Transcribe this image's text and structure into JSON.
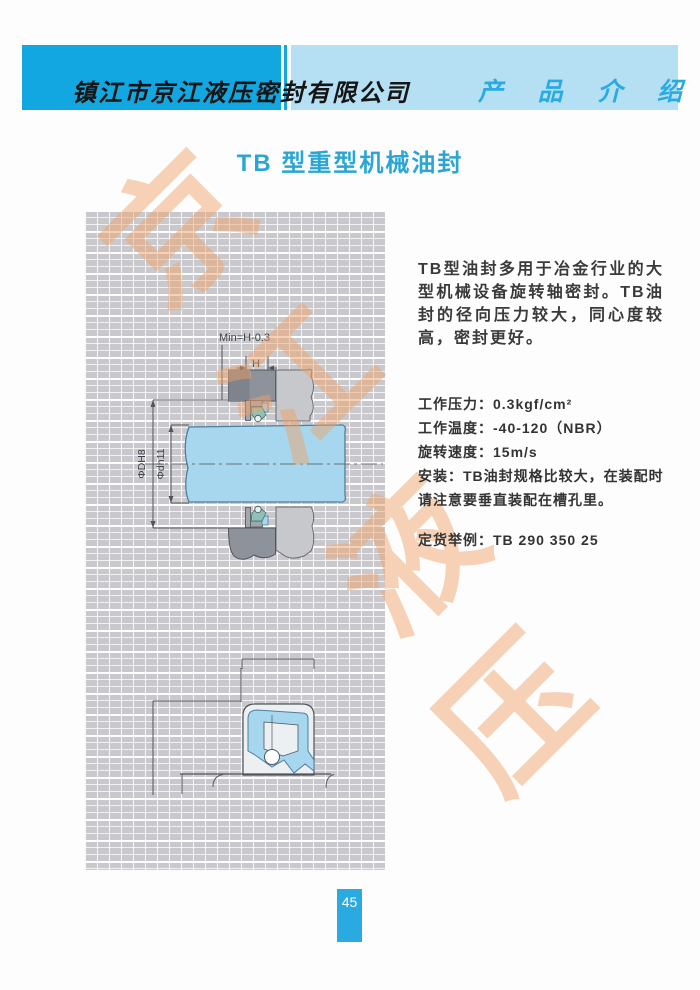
{
  "colors": {
    "accent": "#29ABE2",
    "header_dark": "#12A7E0",
    "header_light": "#B5DFF3",
    "title": "#2BA6D4",
    "watermark": "#F0A268",
    "shaft_blue": "#A6D7EE",
    "shaft_outline": "#4E7F9E",
    "grid_bg": "#C9C9CD"
  },
  "header": {
    "company": "镇江市京江液压密封有限公司",
    "section_title": "产 品 介 绍"
  },
  "page_title": "TB 型重型机械油封",
  "intro_text": "TB型油封多用于冶金行业的大型机械设备旋转轴密封。TB油封的径向压力较大，同心度较高，密封更好。",
  "specs": {
    "pressure_label": "工作压力：",
    "pressure_value": "0.3kgf/cm²",
    "temperature_label": "工作温度：",
    "temperature_value": "-40-120（NBR）",
    "speed_label": "旋转速度：",
    "speed_value": "15m/s",
    "install_label": "安装：",
    "install_value": "TB油封规格比较大，在装配时请注意要垂直装配在槽孔里。",
    "order_label": "定货举例：",
    "order_value": "TB 290 350 25"
  },
  "diagram_labels": {
    "min_height": "Min=H-0.3",
    "height": "H",
    "outer_dia": "ΦDH8",
    "inner_dia": "Φdh11"
  },
  "watermark_chars": [
    "京",
    "江",
    "液",
    "压"
  ],
  "page_number": "45"
}
